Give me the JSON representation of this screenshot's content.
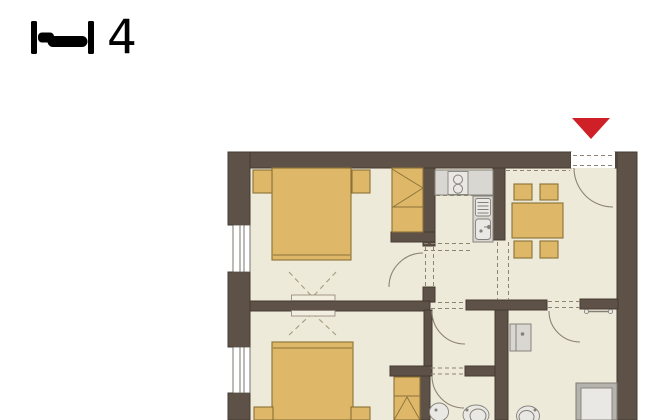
{
  "header": {
    "capacity_label": "4",
    "capacity_icon": "bed-icon"
  },
  "plan": {
    "entrance_marker_icon": "entrance-arrow-icon",
    "rooms": [
      "bedroom-1",
      "bedroom-2",
      "kitchen",
      "dining-room",
      "hallway",
      "vestibule",
      "wc-room",
      "shower-room"
    ],
    "fixtures": [
      "double-bed",
      "nightstand",
      "wardrobe",
      "kitchen-counter",
      "hob",
      "sink",
      "dining-table",
      "chair",
      "washbasin",
      "toilet",
      "shower",
      "towel-rail"
    ]
  },
  "colors": {
    "wall": "#5e5248",
    "wall-line": "#443b31",
    "floor": "#eeead9",
    "furniture": "#deb868",
    "furniture-line": "#8a7137",
    "fixture": "#d9d7d1",
    "fixture-inner": "#e9e8e4",
    "fixture-line": "#85817a",
    "shower-frame": "#b5b3ad",
    "panel": "#f2eee0",
    "line": "#8d8375",
    "dash": "#8d8274",
    "dashx": "#a79a80",
    "accent": "#cf2027",
    "ink": "#000000",
    "page": "#ffffff"
  }
}
